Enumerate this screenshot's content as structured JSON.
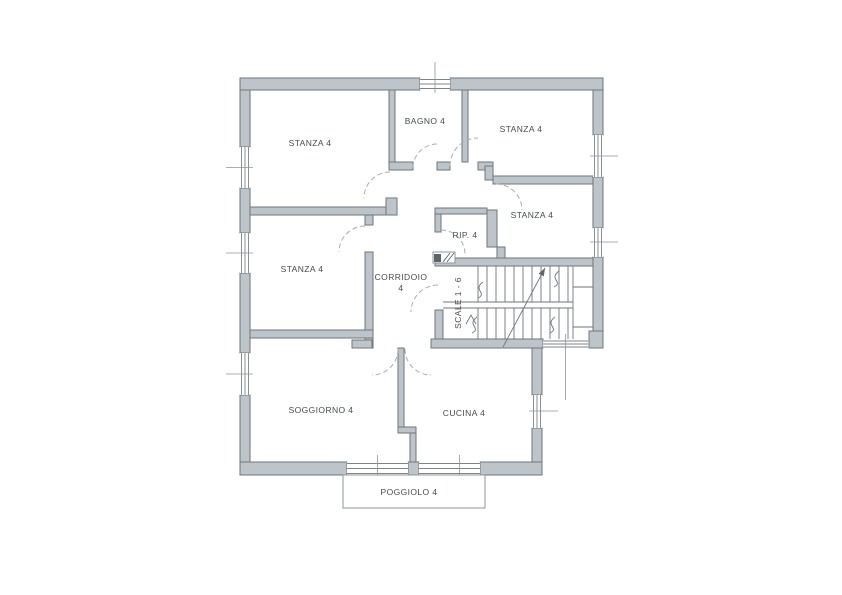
{
  "plan": {
    "rooms": {
      "stanza_nw": {
        "label": "STANZA 4"
      },
      "bagno": {
        "label": "BAGNO 4"
      },
      "stanza_ne": {
        "label": "STANZA 4"
      },
      "stanza_e": {
        "label": "STANZA 4"
      },
      "rip": {
        "label": "RIP. 4"
      },
      "stanza_w": {
        "label": "STANZA 4"
      },
      "corridoio": {
        "line1": "CORRIDOIO",
        "line2": "4"
      },
      "scale": {
        "label": "SCALE 1 - 6"
      },
      "soggiorno": {
        "label": "SOGGIORNO 4"
      },
      "cucina": {
        "label": "CUCINA 4"
      },
      "poggiolo": {
        "label": "POGGIOLO 4"
      }
    },
    "colors": {
      "wall_fill": "#bec5ca",
      "wall_stroke": "#6e767c",
      "line": "#7c848a",
      "door_arc": "#a7aeb3",
      "text": "#454b4f",
      "background": "#ffffff"
    }
  }
}
